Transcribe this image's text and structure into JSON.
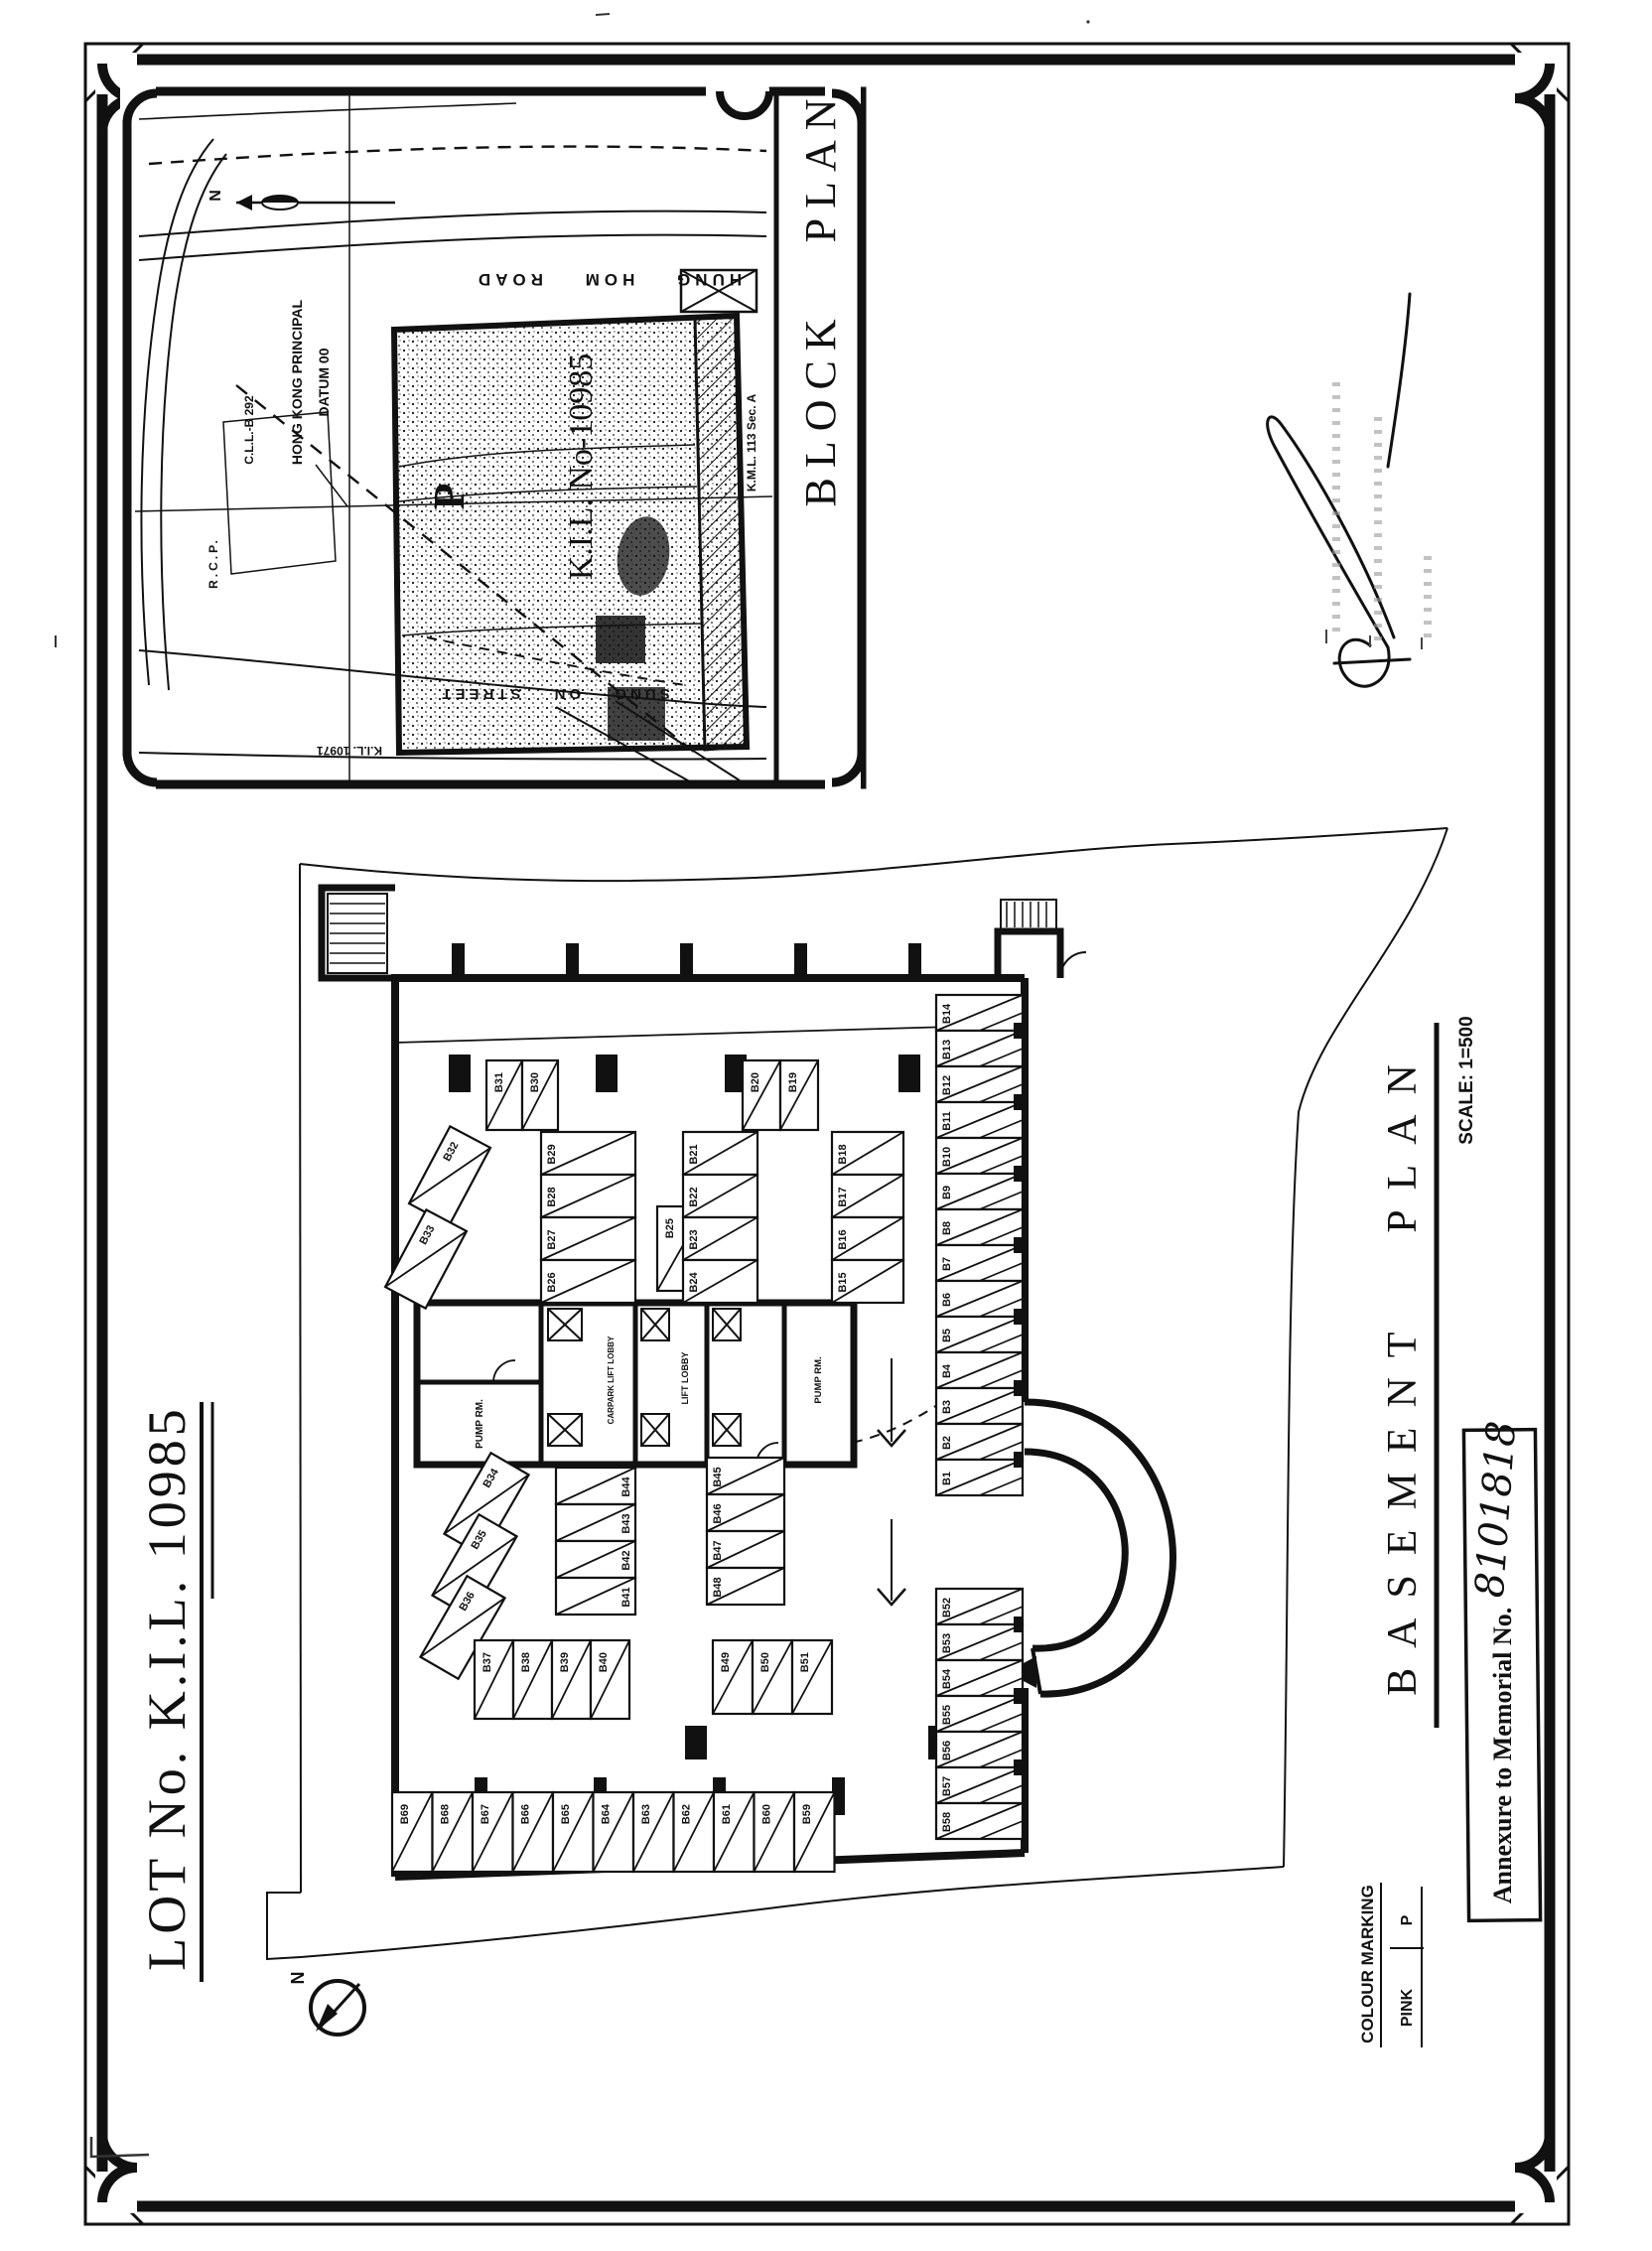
{
  "page": {
    "lot_title": "LOT No. K.I.L. 10985"
  },
  "block_plan": {
    "title": "BLOCK PLAN",
    "north_label": "N",
    "road_hung_hom": "HUNG HOM ROAD",
    "road_sung_on": "SUNG ON STREET",
    "lot_label": "K.I.L. No-10985",
    "parking_mark": "P",
    "datum_line1": "HONG KONG PRINCIPAL",
    "datum_line2": "DATUM 00",
    "cll_label": "C.L.L.-B 292",
    "rcp_label": "R.C.P.",
    "kil_10971": "K.I.L. 10971",
    "kml_label": "K.M.L. 113 Sec. A"
  },
  "basement_plan": {
    "title": "BASEMENT PLAN",
    "scale": "SCALE: 1=500",
    "north_label": "N",
    "rooms": {
      "pump_rm_1": "PUMP RM.",
      "pump_rm_2": "PUMP RM.",
      "carpark_lift_lobby": "CARPARK LIFT LOBBY",
      "lift_lobby": "LIFT LOBBY"
    },
    "stall_groups": [
      {
        "id": "pair-30-31",
        "labels": [
          "B31",
          "B30"
        ]
      },
      {
        "id": "angled-32-33",
        "labels": [
          "B32",
          "B33"
        ]
      },
      {
        "id": "col-29-26",
        "labels": [
          "B29",
          "B28",
          "B27",
          "B26"
        ]
      },
      {
        "id": "single-25",
        "labels": [
          "B25"
        ]
      },
      {
        "id": "pair-20-19",
        "labels": [
          "B20",
          "B19"
        ]
      },
      {
        "id": "col-21-24",
        "labels": [
          "B21",
          "B22",
          "B23",
          "B24"
        ]
      },
      {
        "id": "col-18-15",
        "labels": [
          "B18",
          "B17",
          "B16",
          "B15"
        ]
      },
      {
        "id": "right-col",
        "labels": [
          "B14",
          "B13",
          "B12",
          "B11",
          "B10",
          "B9",
          "B8",
          "B7",
          "B6",
          "B5",
          "B4",
          "B3",
          "B2",
          "B1"
        ]
      },
      {
        "id": "angled-34-36",
        "labels": [
          "B34",
          "B35",
          "B36"
        ]
      },
      {
        "id": "col-41-44",
        "labels": [
          "B44",
          "B43",
          "B42",
          "B41"
        ]
      },
      {
        "id": "col-45-48",
        "labels": [
          "B45",
          "B46",
          "B47",
          "B48"
        ]
      },
      {
        "id": "row-37-40",
        "labels": [
          "B37",
          "B38",
          "B39",
          "B40"
        ]
      },
      {
        "id": "row-49-51",
        "labels": [
          "B49",
          "B50",
          "B51"
        ]
      },
      {
        "id": "col-52-58",
        "labels": [
          "B52",
          "B53",
          "B54",
          "B55",
          "B56",
          "B57",
          "B58"
        ]
      },
      {
        "id": "bottom-row",
        "labels": [
          "B69",
          "B68",
          "B67",
          "B66",
          "B65",
          "B64",
          "B63",
          "B62",
          "B61",
          "B60",
          "B59"
        ]
      }
    ]
  },
  "annotations": {
    "annexure_label": "Annexure to Memorial No.",
    "memorial_no": "8101818",
    "colour_marking_title": "COLOUR MARKING",
    "colour_rows": [
      {
        "colour": "PINK",
        "mark": "P"
      }
    ]
  },
  "colors": {
    "ink": "#111111",
    "paper": "#ffffff"
  }
}
